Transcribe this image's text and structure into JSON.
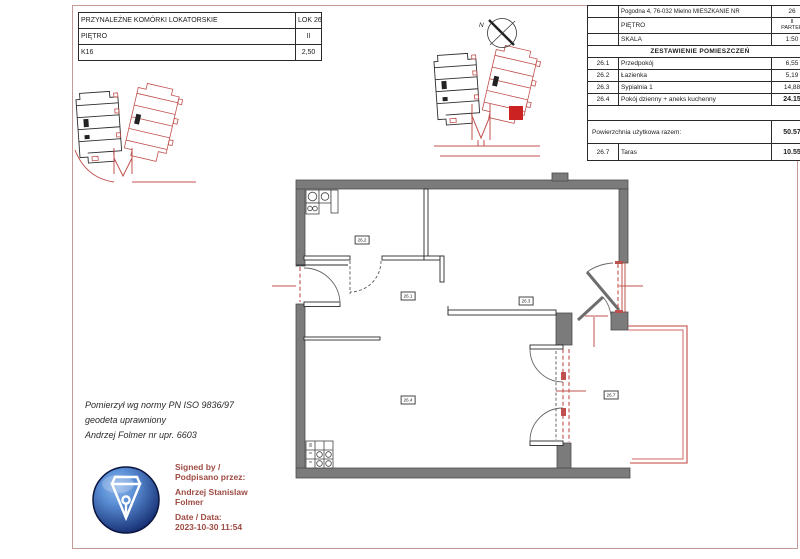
{
  "left_table": {
    "rows": [
      {
        "label": "PRZYNALEŻNE KOMÓRKI LOKATORSKIE",
        "value": "LOK 26"
      },
      {
        "label": "PIĘTRO",
        "value": "II"
      },
      {
        "label": "K16",
        "value": "2,50"
      }
    ]
  },
  "right_table": {
    "address_row": {
      "label": "Pogodna 4, 76-032 Mielno MIESZKANIE NR",
      "value": "26"
    },
    "floor_row": {
      "label": "PIĘTRO",
      "value_line1": "II",
      "value_line2": "PARTER"
    },
    "scale_row": {
      "label": "SKALA",
      "value": "1:50"
    },
    "header": "ZESTAWIENIE POMIESZCZEŃ",
    "rooms": [
      {
        "no": "26.1",
        "name": "Przedpokój",
        "area": "6,55"
      },
      {
        "no": "26.2",
        "name": "Łazienka",
        "area": "5,19"
      },
      {
        "no": "26.3",
        "name": "Sypialnia 1",
        "area": "14,88"
      },
      {
        "no": "26.4",
        "name": "Pokój dzienny + aneks kuchenny",
        "area": "24.15"
      }
    ],
    "total_row": {
      "label": "Powierzchnia użytkowa razem:",
      "value": "50.57"
    },
    "terrace_row": {
      "no": "26.7",
      "name": "Taras",
      "area": "10.55"
    }
  },
  "plan_labels": {
    "hall": "26.1",
    "bathroom": "26.2",
    "bedroom": "26.3",
    "living": "26.4",
    "terrace": "26.7"
  },
  "compass": {
    "label": "N"
  },
  "surveyor_note": {
    "line1": "Pomierzył wg normy  PN ISO 9836/97",
    "line2": "geodeta uprawniony",
    "line3": "Andrzej Folmer nr upr. 6603"
  },
  "signature": {
    "line1": "Signed by /",
    "line2": "Podpisano przez:",
    "name_line1": "Andrzej Stanislaw",
    "name_line2": "Folmer",
    "date_label": "Date / Data:",
    "date_value": "2023-10-30 11:54"
  },
  "colors": {
    "wall-gray": "#7b7b7b",
    "plan-red": "#c0504d",
    "terrace-red": "#cd6762",
    "frame-pink": "#c49a96",
    "sig-text": "#9e4b42",
    "sphere-dark": "#132a6e",
    "sphere-light": "#5b8fd6"
  }
}
